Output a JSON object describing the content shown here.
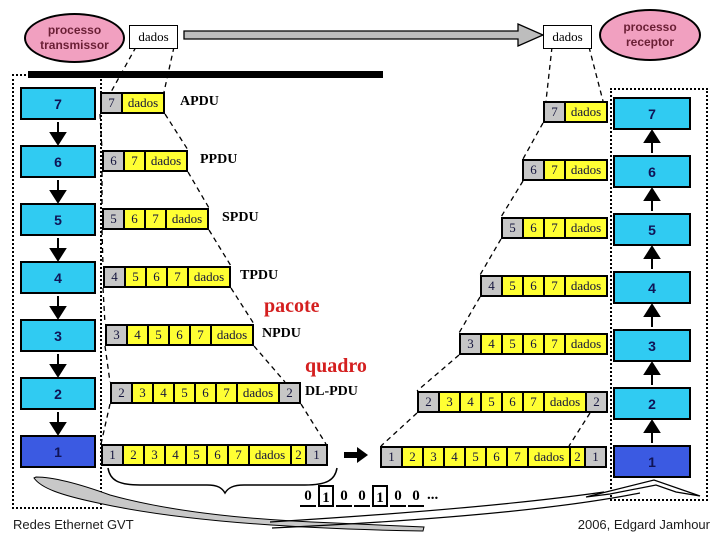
{
  "transmitter": {
    "line1": "processo",
    "line2": "transmissor"
  },
  "receptor": {
    "line1": "processo",
    "line2": "receptor"
  },
  "dados_left": "dados",
  "dados_right": "dados",
  "stack_left": [
    "7",
    "6",
    "5",
    "4",
    "3",
    "2",
    "1"
  ],
  "stack_right": [
    "7",
    "6",
    "5",
    "4",
    "3",
    "2",
    "1"
  ],
  "rows_left": [
    {
      "id": "l7",
      "cells": [
        {
          "t": "7",
          "k": "g"
        },
        {
          "t": "dados",
          "k": "d"
        }
      ]
    },
    {
      "id": "l6",
      "cells": [
        {
          "t": "6",
          "k": "g"
        },
        {
          "t": "7",
          "k": "y"
        },
        {
          "t": "dados",
          "k": "d"
        }
      ]
    },
    {
      "id": "l5",
      "cells": [
        {
          "t": "5",
          "k": "g"
        },
        {
          "t": "6",
          "k": "y"
        },
        {
          "t": "7",
          "k": "y"
        },
        {
          "t": "dados",
          "k": "d"
        }
      ]
    },
    {
      "id": "l4",
      "cells": [
        {
          "t": "4",
          "k": "g"
        },
        {
          "t": "5",
          "k": "y"
        },
        {
          "t": "6",
          "k": "y"
        },
        {
          "t": "7",
          "k": "y"
        },
        {
          "t": "dados",
          "k": "d"
        }
      ]
    },
    {
      "id": "l3",
      "cells": [
        {
          "t": "3",
          "k": "g"
        },
        {
          "t": "4",
          "k": "y"
        },
        {
          "t": "5",
          "k": "y"
        },
        {
          "t": "6",
          "k": "y"
        },
        {
          "t": "7",
          "k": "y"
        },
        {
          "t": "dados",
          "k": "d"
        }
      ]
    },
    {
      "id": "l2",
      "cells": [
        {
          "t": "2",
          "k": "g"
        },
        {
          "t": "3",
          "k": "y"
        },
        {
          "t": "4",
          "k": "y"
        },
        {
          "t": "5",
          "k": "y"
        },
        {
          "t": "6",
          "k": "y"
        },
        {
          "t": "7",
          "k": "y"
        },
        {
          "t": "dados",
          "k": "d"
        },
        {
          "t": "2",
          "k": "g"
        }
      ]
    },
    {
      "id": "l1",
      "cells": [
        {
          "t": "1",
          "k": "g"
        },
        {
          "t": "2",
          "k": "y"
        },
        {
          "t": "3",
          "k": "y"
        },
        {
          "t": "4",
          "k": "y"
        },
        {
          "t": "5",
          "k": "y"
        },
        {
          "t": "6",
          "k": "y"
        },
        {
          "t": "7",
          "k": "y"
        },
        {
          "t": "dados",
          "k": "d"
        },
        {
          "t": "2",
          "k": "s"
        },
        {
          "t": "1",
          "k": "g"
        }
      ]
    }
  ],
  "rows_right": [
    {
      "id": "r7",
      "cells": [
        {
          "t": "7",
          "k": "g"
        },
        {
          "t": "dados",
          "k": "d"
        }
      ]
    },
    {
      "id": "r6",
      "cells": [
        {
          "t": "6",
          "k": "g"
        },
        {
          "t": "7",
          "k": "y"
        },
        {
          "t": "dados",
          "k": "d"
        }
      ]
    },
    {
      "id": "r5",
      "cells": [
        {
          "t": "5",
          "k": "g"
        },
        {
          "t": "6",
          "k": "y"
        },
        {
          "t": "7",
          "k": "y"
        },
        {
          "t": "dados",
          "k": "d"
        }
      ]
    },
    {
      "id": "r4",
      "cells": [
        {
          "t": "4",
          "k": "g"
        },
        {
          "t": "5",
          "k": "y"
        },
        {
          "t": "6",
          "k": "y"
        },
        {
          "t": "7",
          "k": "y"
        },
        {
          "t": "dados",
          "k": "d"
        }
      ]
    },
    {
      "id": "r3",
      "cells": [
        {
          "t": "3",
          "k": "g"
        },
        {
          "t": "4",
          "k": "y"
        },
        {
          "t": "5",
          "k": "y"
        },
        {
          "t": "6",
          "k": "y"
        },
        {
          "t": "7",
          "k": "y"
        },
        {
          "t": "dados",
          "k": "d"
        }
      ]
    },
    {
      "id": "r2",
      "cells": [
        {
          "t": "2",
          "k": "g"
        },
        {
          "t": "3",
          "k": "y"
        },
        {
          "t": "4",
          "k": "y"
        },
        {
          "t": "5",
          "k": "y"
        },
        {
          "t": "6",
          "k": "y"
        },
        {
          "t": "7",
          "k": "y"
        },
        {
          "t": "dados",
          "k": "d"
        },
        {
          "t": "2",
          "k": "g"
        }
      ]
    },
    {
      "id": "r1",
      "cells": [
        {
          "t": "1",
          "k": "g"
        },
        {
          "t": "2",
          "k": "y"
        },
        {
          "t": "3",
          "k": "y"
        },
        {
          "t": "4",
          "k": "y"
        },
        {
          "t": "5",
          "k": "y"
        },
        {
          "t": "6",
          "k": "y"
        },
        {
          "t": "7",
          "k": "y"
        },
        {
          "t": "dados",
          "k": "d"
        },
        {
          "t": "2",
          "k": "s"
        },
        {
          "t": "1",
          "k": "g"
        }
      ]
    }
  ],
  "pdu_labels": [
    {
      "id": "apdu",
      "text": "APDU",
      "style": "black"
    },
    {
      "id": "ppdu",
      "text": "PPDU",
      "style": "black"
    },
    {
      "id": "spdu",
      "text": "SPDU",
      "style": "black"
    },
    {
      "id": "tpdu",
      "text": "TPDU",
      "style": "black"
    },
    {
      "id": "pacote",
      "text": "pacote",
      "style": "red"
    },
    {
      "id": "npdu",
      "text": "NPDU",
      "style": "black"
    },
    {
      "id": "quadro",
      "text": "quadro",
      "style": "red"
    },
    {
      "id": "dlpdu",
      "text": "DL-PDU",
      "style": "black"
    }
  ],
  "bits": {
    "sequence": [
      "0",
      "1",
      "0",
      "0",
      "1",
      "0",
      "0"
    ],
    "ellipsis": "..."
  },
  "footer": {
    "left": "Redes Ethernet GVT",
    "right": "2006, Edgard Jamhour"
  },
  "colors": {
    "cyan": "#30CBF2",
    "blue": "#3B5AE2",
    "yellow": "#FFFF33",
    "gray": "#C6C6C6",
    "pink": "#F1A0C0",
    "redlabel": "#D41F1F",
    "arrowgray": "#BDBDBD",
    "swoosh": "#C8C8C8"
  }
}
